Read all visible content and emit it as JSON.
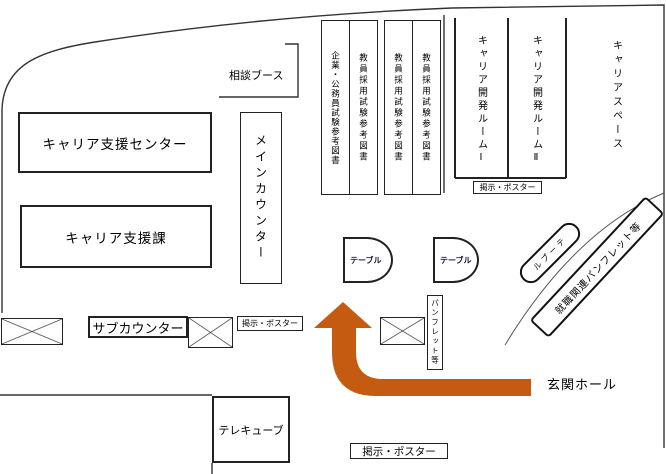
{
  "colors": {
    "arrow": "#C55A11",
    "wall": "#000000"
  },
  "areas": {
    "consult_booth": {
      "label": "相談ブース"
    },
    "career_support_center": {
      "label": "キャリア支援センター"
    },
    "career_support_division": {
      "label": "キャリア支援課"
    },
    "main_counter": {
      "label": "メインカウンター"
    },
    "career_dev_room_1": {
      "label": "キャリア開発ルームⅠ"
    },
    "career_dev_room_2": {
      "label": "キャリア開発ルームⅡ"
    },
    "career_space": {
      "label": "キャリアスペース"
    },
    "sub_counter": {
      "label": "サブカウンター"
    },
    "tele_cube": {
      "label": "テレキューブ"
    },
    "entrance_hall": {
      "label": "玄関ホール"
    }
  },
  "bookshelves": [
    {
      "label": "企業・公務員試験参考図書"
    },
    {
      "label": "教員採用試験参考図書"
    },
    {
      "label": "教員採用試験参考図書"
    },
    {
      "label": "教員採用試験参考図書"
    }
  ],
  "furniture": {
    "table_1": {
      "label": "テーブル"
    },
    "table_2": {
      "label": "テーブル"
    },
    "table_3": {
      "label": "テーブル"
    },
    "pamphlet_rack": {
      "label": "パンフレット等"
    },
    "job_pamphlet_rack": {
      "label": "就職関連パンフレット等"
    }
  },
  "posters": {
    "career_rooms": {
      "label": "掲示・ポスター"
    },
    "sub_counter": {
      "label": "掲示・ポスター"
    },
    "entrance": {
      "label": "掲示・ポスター"
    }
  }
}
